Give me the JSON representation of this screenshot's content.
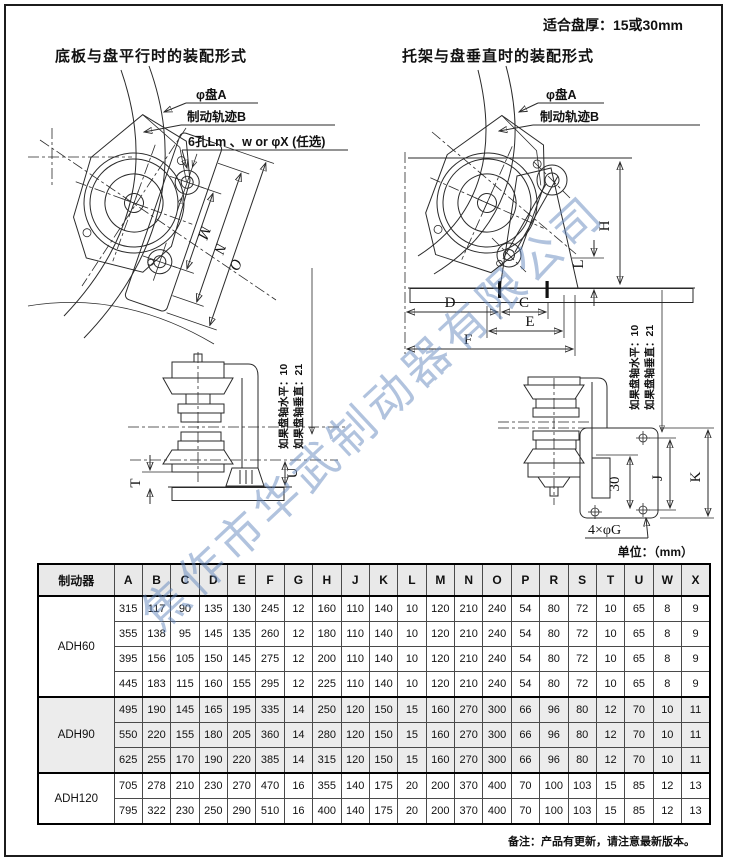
{
  "page": {
    "thickness_note": "适合盘厚：15或30mm",
    "unit_note": "单位：（mm）",
    "footer_note": "备注：产品有更新，请注意最新版本。",
    "watermark": "焦作市华武制动器有限公司",
    "colors": {
      "watermark_blue": "#7e9ecf",
      "table_shade": "#ececec",
      "line": "#2a2a2a"
    }
  },
  "sections": {
    "left_title": "底板与盘平行时的装配形式",
    "right_title": "托架与盘垂直时的装配形式"
  },
  "callouts": {
    "disc": "φ盘A",
    "track": "制动轨迹B",
    "holes": "6孔Lm 、w or φX (任选)"
  },
  "axis_notes": {
    "horizontal": "如果盘轴水平：10",
    "vertical": "如果盘轴垂直：21"
  },
  "dims": {
    "top_left": [
      "M",
      "N",
      "O"
    ],
    "top_right": [
      "H",
      "L",
      "D",
      "C",
      "E",
      "F"
    ],
    "bottom_left": [
      "T",
      "U"
    ],
    "bottom_right": [
      "30",
      "J",
      "K"
    ],
    "hole_label": "4×φG"
  },
  "table": {
    "model_header": "制动器",
    "columns": [
      "A",
      "B",
      "C",
      "D",
      "E",
      "F",
      "G",
      "H",
      "J",
      "K",
      "L",
      "M",
      "N",
      "O",
      "P",
      "R",
      "S",
      "T",
      "U",
      "W",
      "X"
    ],
    "groups": [
      {
        "model": "ADH60",
        "shaded": false,
        "rows": [
          [
            315,
            117,
            90,
            135,
            130,
            245,
            12,
            160,
            110,
            140,
            10,
            120,
            210,
            240,
            54,
            80,
            72,
            10,
            65,
            8,
            9
          ],
          [
            355,
            138,
            95,
            145,
            135,
            260,
            12,
            180,
            110,
            140,
            10,
            120,
            210,
            240,
            54,
            80,
            72,
            10,
            65,
            8,
            9
          ],
          [
            395,
            156,
            105,
            150,
            145,
            275,
            12,
            200,
            110,
            140,
            10,
            120,
            210,
            240,
            54,
            80,
            72,
            10,
            65,
            8,
            9
          ],
          [
            445,
            183,
            115,
            160,
            155,
            295,
            12,
            225,
            110,
            140,
            10,
            120,
            210,
            240,
            54,
            80,
            72,
            10,
            65,
            8,
            9
          ]
        ]
      },
      {
        "model": "ADH90",
        "shaded": true,
        "rows": [
          [
            495,
            190,
            145,
            165,
            195,
            335,
            14,
            250,
            120,
            150,
            15,
            160,
            270,
            300,
            66,
            96,
            80,
            12,
            70,
            10,
            11
          ],
          [
            550,
            220,
            155,
            180,
            205,
            360,
            14,
            280,
            120,
            150,
            15,
            160,
            270,
            300,
            66,
            96,
            80,
            12,
            70,
            10,
            11
          ],
          [
            625,
            255,
            170,
            190,
            220,
            385,
            14,
            315,
            120,
            150,
            15,
            160,
            270,
            300,
            66,
            96,
            80,
            12,
            70,
            10,
            11
          ]
        ]
      },
      {
        "model": "ADH120",
        "shaded": false,
        "rows": [
          [
            705,
            278,
            210,
            230,
            270,
            470,
            16,
            355,
            140,
            175,
            20,
            200,
            370,
            400,
            70,
            100,
            103,
            15,
            85,
            12,
            13
          ],
          [
            795,
            322,
            230,
            250,
            290,
            510,
            16,
            400,
            140,
            175,
            20,
            200,
            370,
            400,
            70,
            100,
            103,
            15,
            85,
            12,
            13
          ]
        ]
      }
    ]
  }
}
